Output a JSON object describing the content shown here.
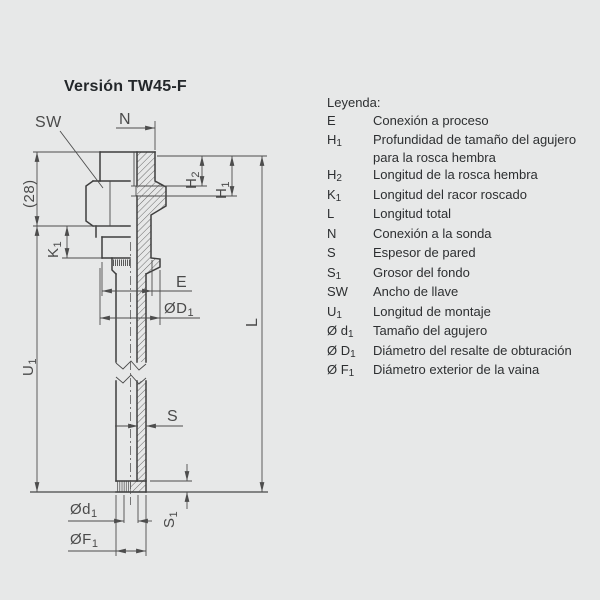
{
  "title": "Versión TW45-F",
  "colors": {
    "background": "#e7e8e8",
    "outline": "#3e3e3e",
    "dimension": "#4d4d4d",
    "text": "#2d2f31"
  },
  "legend": {
    "heading": "Leyenda:",
    "items": [
      {
        "base": "E",
        "sub": "",
        "desc": "Conexión a proceso"
      },
      {
        "base": "H",
        "sub": "1",
        "desc": "Profundidad de tamaño del agujero para la rosca hembra"
      },
      {
        "base": "H",
        "sub": "2",
        "desc": "Longitud de la rosca hembra"
      },
      {
        "base": "K",
        "sub": "1",
        "desc": "Longitud del racor roscado"
      },
      {
        "base": "L",
        "sub": "",
        "desc": "Longitud total"
      },
      {
        "base": "N",
        "sub": "",
        "desc": "Conexión a la sonda"
      },
      {
        "base": "S",
        "sub": "",
        "desc": "Espesor de pared"
      },
      {
        "base": "S",
        "sub": "1",
        "desc": "Grosor del fondo"
      },
      {
        "base": "SW",
        "sub": "",
        "desc": "Ancho de llave"
      },
      {
        "base": "U",
        "sub": "1",
        "desc": "Longitud de montaje"
      },
      {
        "base": "Ø d",
        "sub": "1",
        "desc": "Tamaño del agujero"
      },
      {
        "base": "Ø D",
        "sub": "1",
        "desc": "Diámetro del resalte de obturación"
      },
      {
        "base": "Ø F",
        "sub": "1",
        "desc": "Diámetro exterior de la vaina"
      }
    ]
  },
  "drawing": {
    "labels": {
      "sw": "SW",
      "n": "N",
      "mm28": "(28)",
      "l": "L",
      "e": "E",
      "s": "S",
      "k": {
        "b": "K",
        "s": "1"
      },
      "u": {
        "b": "U",
        "s": "1"
      },
      "h1": {
        "b": "H",
        "s": "1"
      },
      "h2": {
        "b": "H",
        "s": "2"
      },
      "s1": {
        "b": "S",
        "s": "1"
      },
      "d1": {
        "b": "Ød",
        "s": "1"
      },
      "D1": {
        "b": "ØD",
        "s": "1"
      },
      "f1": {
        "b": "ØF",
        "s": "1"
      }
    }
  }
}
